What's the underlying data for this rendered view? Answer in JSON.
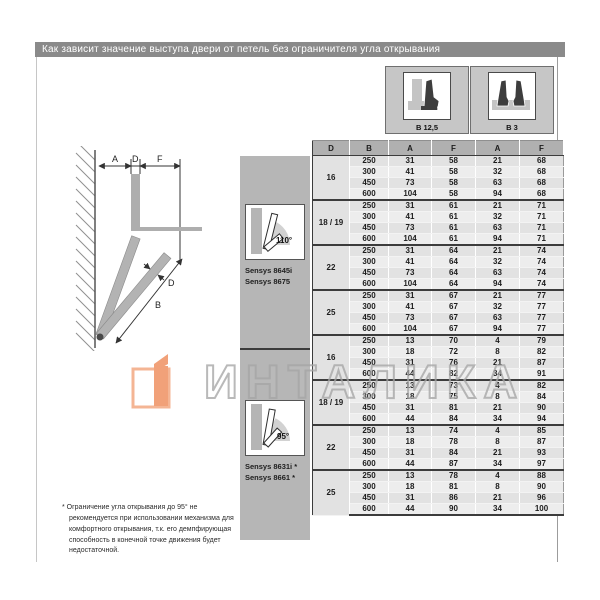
{
  "title": "Как зависит значение выступа двери от петель без ограничителя угла открывания",
  "legend": {
    "boxes": [
      {
        "label": "B 12,5",
        "icon": "hinge-overlay-mounting-icon"
      },
      {
        "label": "B 3",
        "icon": "hinge-twin-mounting-icon"
      }
    ]
  },
  "diagram": {
    "dims": [
      "A",
      "D",
      "F"
    ],
    "thickness_label": "D",
    "height_label": "B"
  },
  "table": {
    "header": [
      "D",
      "B",
      "A",
      "F",
      "A",
      "F"
    ]
  },
  "sections": [
    {
      "angle": "110°",
      "models": [
        "Sensys 8645i",
        "Sensys 8675"
      ],
      "groups": [
        {
          "d": "16",
          "rows": [
            [
              250,
              31,
              58,
              21,
              68
            ],
            [
              300,
              41,
              58,
              32,
              68
            ],
            [
              450,
              73,
              58,
              63,
              68
            ],
            [
              600,
              104,
              58,
              94,
              68
            ]
          ]
        },
        {
          "d": "18 / 19",
          "rows": [
            [
              250,
              31,
              61,
              21,
              71
            ],
            [
              300,
              41,
              61,
              32,
              71
            ],
            [
              450,
              73,
              61,
              63,
              71
            ],
            [
              600,
              104,
              61,
              94,
              71
            ]
          ]
        },
        {
          "d": "22",
          "rows": [
            [
              250,
              31,
              64,
              21,
              74
            ],
            [
              300,
              41,
              64,
              32,
              74
            ],
            [
              450,
              73,
              64,
              63,
              74
            ],
            [
              600,
              104,
              64,
              94,
              74
            ]
          ]
        },
        {
          "d": "25",
          "rows": [
            [
              250,
              31,
              67,
              21,
              77
            ],
            [
              300,
              41,
              67,
              32,
              77
            ],
            [
              450,
              73,
              67,
              63,
              77
            ],
            [
              600,
              104,
              67,
              94,
              77
            ]
          ]
        }
      ]
    },
    {
      "angle": "95°",
      "models": [
        "Sensys 8631i *",
        "Sensys 8661 *"
      ],
      "groups": [
        {
          "d": "16",
          "rows": [
            [
              250,
              13,
              70,
              4,
              79
            ],
            [
              300,
              18,
              72,
              8,
              82
            ],
            [
              450,
              31,
              76,
              21,
              87
            ],
            [
              600,
              44,
              82,
              34,
              91
            ]
          ]
        },
        {
          "d": "18 / 19",
          "rows": [
            [
              250,
              13,
              73,
              4,
              82
            ],
            [
              300,
              18,
              75,
              8,
              84
            ],
            [
              450,
              31,
              81,
              21,
              90
            ],
            [
              600,
              44,
              84,
              34,
              94
            ]
          ]
        },
        {
          "d": "22",
          "rows": [
            [
              250,
              13,
              74,
              4,
              85
            ],
            [
              300,
              18,
              78,
              8,
              87
            ],
            [
              450,
              31,
              84,
              21,
              93
            ],
            [
              600,
              44,
              87,
              34,
              97
            ]
          ]
        },
        {
          "d": "25",
          "rows": [
            [
              250,
              13,
              78,
              4,
              88
            ],
            [
              300,
              18,
              81,
              8,
              90
            ],
            [
              450,
              31,
              86,
              21,
              96
            ],
            [
              600,
              44,
              90,
              34,
              100
            ]
          ]
        }
      ]
    }
  ],
  "footnote": "* Ограничение угла открывания до 95° не рекомендуется при использовании механизма для комфортного открывания, т.к. его демпфирующая способность в конечной точке движения будет недостаточной.",
  "watermark": {
    "text": "ИНТАЛИКА",
    "logo_color": "#ee8754"
  },
  "colors": {
    "title_bar": "#8a8a8a",
    "sidebar": "#b6b6b6",
    "header_row": "#b0b0b0",
    "accent_orange": "#ee8754"
  }
}
